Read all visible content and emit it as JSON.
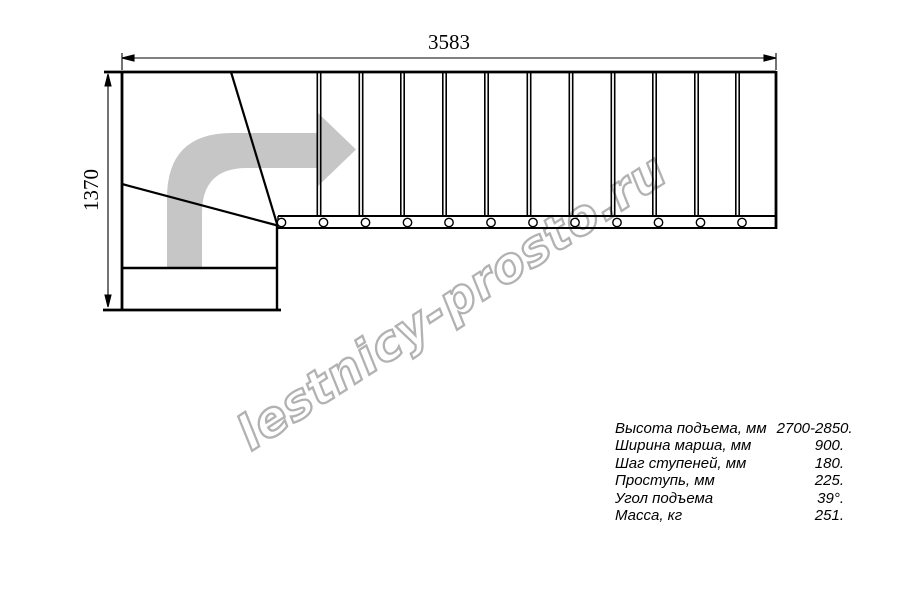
{
  "drawing": {
    "title": "stair-plan-top-view",
    "top_dimension_mm": "3583",
    "left_dimension_mm": "1370",
    "straight_flight_treads": 12,
    "winder_treads": 3
  },
  "watermark": {
    "text": "lestnicy-prosto.ru"
  },
  "specs": {
    "rows": [
      {
        "label": "Высота подъема, мм",
        "value": "2700-2850."
      },
      {
        "label": "Ширина марша, мм",
        "value": "900."
      },
      {
        "label": "Шаг ступеней, мм",
        "value": "180."
      },
      {
        "label": "Проступь, мм",
        "value": "225."
      },
      {
        "label": "Угол подъема",
        "value": "39°."
      },
      {
        "label": "Масса, кг",
        "value": "251."
      }
    ]
  },
  "colors": {
    "line": "#000000",
    "direction_arrow_gray": "#c6c6c6",
    "watermark_gray": "#b2b2b2",
    "background": "#ffffff"
  }
}
